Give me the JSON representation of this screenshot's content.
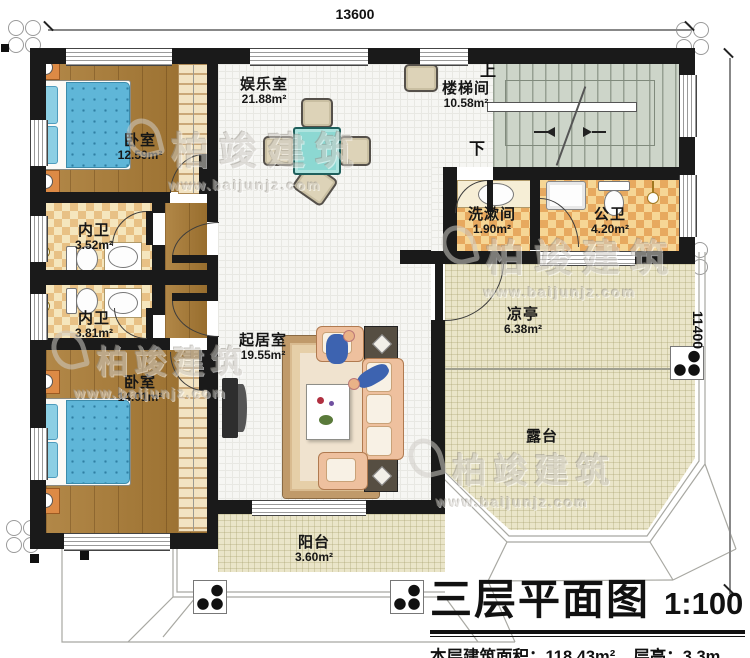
{
  "plan": {
    "title": "三层平面图",
    "scale": "1:100",
    "stats": {
      "area_label": "本层建筑面积：",
      "area_value": "118.43m²",
      "height_label": "层高：",
      "height_value": "3.3m"
    },
    "dimensions": {
      "width": "13600",
      "height": "11400"
    }
  },
  "stairs": {
    "up": "上",
    "down": "下"
  },
  "rooms": [
    {
      "id": "bedroom-top",
      "name": "卧室",
      "area": "12.59m²"
    },
    {
      "id": "entertainment",
      "name": "娱乐室",
      "area": "21.88m²"
    },
    {
      "id": "stairwell",
      "name": "楼梯间",
      "area": "10.58m²"
    },
    {
      "id": "inner-bath-1",
      "name": "内卫",
      "area": "3.52m²"
    },
    {
      "id": "inner-bath-2",
      "name": "内卫",
      "area": "3.81m²"
    },
    {
      "id": "living-room",
      "name": "起居室",
      "area": "19.55m²"
    },
    {
      "id": "washroom",
      "name": "洗漱间",
      "area": "1.90m²"
    },
    {
      "id": "public-bath",
      "name": "公卫",
      "area": "4.20m²"
    },
    {
      "id": "pavilion",
      "name": "凉亭",
      "area": "6.38m²"
    },
    {
      "id": "bedroom-bottom",
      "name": "卧室",
      "area": "14.01m²"
    },
    {
      "id": "terrace",
      "name": "露台",
      "area": ""
    },
    {
      "id": "balcony",
      "name": "阳台",
      "area": "3.60m²"
    }
  ],
  "watermark": {
    "brand": "柏竣建筑",
    "url": "www.baijunjz.com"
  },
  "colors": {
    "wall": "#1a1a1a",
    "wood_floor": "#a97a33",
    "tile_cream": "#f5e6bd",
    "tile_cream_dark": "#e8c185",
    "tile_orange": "#f6d695",
    "tile_orange_dark": "#e7a95f",
    "floor_white": "#f6f6f3",
    "floor_stair": "#cdd5c9",
    "floor_outdoor": "#eae5c9",
    "bed_blue": "#66b9d8",
    "table_teal": "#8cd8d2",
    "sofa_peach": "#eec09e",
    "nightstand_orange": "#dd8a45"
  }
}
